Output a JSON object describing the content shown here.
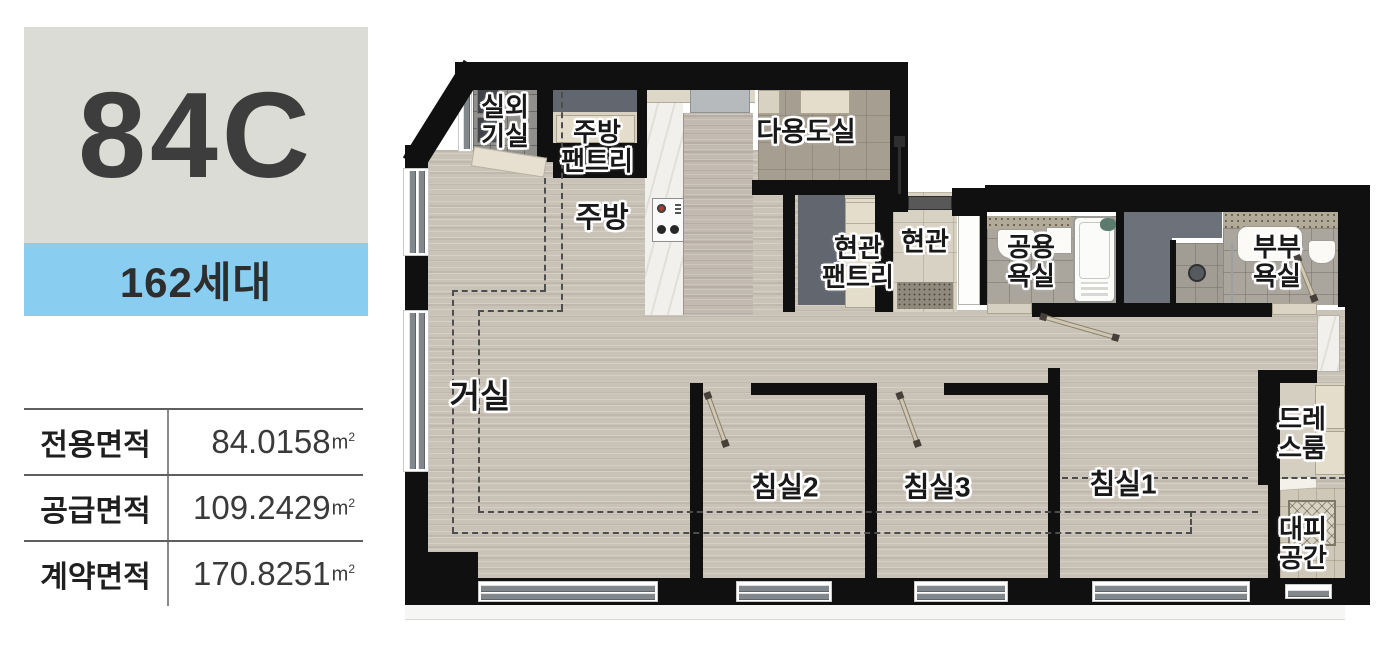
{
  "panel": {
    "unit_type": "84C",
    "households": "162세대",
    "area_table": [
      {
        "label": "전용면적",
        "value": "84.0158",
        "unit": "m",
        "unit_exp": "2"
      },
      {
        "label": "공급면적",
        "value": "109.2429",
        "unit": "m",
        "unit_exp": "2"
      },
      {
        "label": "계약면적",
        "value": "170.8251",
        "unit": "m",
        "unit_exp": "2"
      }
    ]
  },
  "floor_plan": {
    "rooms": [
      {
        "id": "outdoor-unit-room",
        "label": "실외\n기실"
      },
      {
        "id": "kitchen-pantry",
        "label": "주방\n팬트리"
      },
      {
        "id": "kitchen",
        "label": "주방"
      },
      {
        "id": "utility-room",
        "label": "다용도실"
      },
      {
        "id": "entry-pantry",
        "label": "현관\n팬트리"
      },
      {
        "id": "entry",
        "label": "현관"
      },
      {
        "id": "common-bath",
        "label": "공용\n욕실"
      },
      {
        "id": "master-bath",
        "label": "부부\n욕실"
      },
      {
        "id": "living-room",
        "label": "거실"
      },
      {
        "id": "bedroom2",
        "label": "침실2"
      },
      {
        "id": "bedroom3",
        "label": "침실3"
      },
      {
        "id": "bedroom1",
        "label": "침실1"
      },
      {
        "id": "dress-room",
        "label": "드레\n스룸"
      },
      {
        "id": "refuge-space",
        "label": "대피\n공간"
      }
    ],
    "colors": {
      "wall": "#101010",
      "floor_wood": "#c9c2b6",
      "households_bg": "#89cdf0",
      "type_box_bg": "#dcdcd6",
      "dashed_line": "#4d4d4d"
    }
  }
}
